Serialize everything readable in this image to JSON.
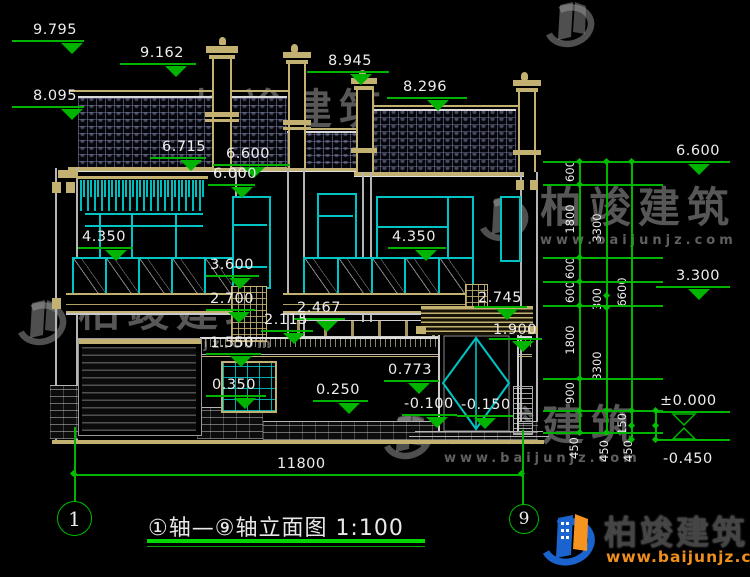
{
  "watermark": {
    "brand": "柏竣建筑",
    "url": "www.baijunjz.com"
  },
  "logo": {
    "brand": "柏竣建筑",
    "url": "www.baijunjz.com"
  },
  "title_block": {
    "title": "①轴—⑨轴立面图 1:100",
    "axis_left": "1",
    "axis_right": "9"
  },
  "drawing": {
    "bottom_dim_label": "11800",
    "elevation_markers": [
      {
        "label": "9.795",
        "tx": 33,
        "ty": 22,
        "lx": 12,
        "ly": 40,
        "lw": 72,
        "ax": 72
      },
      {
        "label": "9.162",
        "tx": 140,
        "ty": 45,
        "lx": 120,
        "ly": 63,
        "lw": 76,
        "ax": 176
      },
      {
        "label": "8.095",
        "tx": 33,
        "ty": 88,
        "lx": 12,
        "ly": 106,
        "lw": 72,
        "ax": 72
      },
      {
        "label": "8.945",
        "tx": 328,
        "ty": 53,
        "lx": 307,
        "ly": 71,
        "lw": 82,
        "ax": 361
      },
      {
        "label": "8.296",
        "tx": 403,
        "ty": 79,
        "lx": 387,
        "ly": 97,
        "lw": 80,
        "ax": 438
      },
      {
        "label": "6.715",
        "tx": 162,
        "ty": 139,
        "lx": 150,
        "ly": 157,
        "lw": 56,
        "ax": 191
      },
      {
        "label": "6.600",
        "tx": 226,
        "ty": 146,
        "lx": 213,
        "ly": 164,
        "lw": 77,
        "ax": 254
      },
      {
        "label": "6.000",
        "tx": 213,
        "ty": 166,
        "lx": 208,
        "ly": 184,
        "lw": 47,
        "ax": 242
      },
      {
        "label": "6.600",
        "tx": 676,
        "ty": 143,
        "lx": 656,
        "ly": 161,
        "lw": 74,
        "ax": 699
      },
      {
        "label": "4.350",
        "tx": 82,
        "ty": 229,
        "lx": 78,
        "ly": 247,
        "lw": 55,
        "ax": 116
      },
      {
        "label": "4.350",
        "tx": 392,
        "ty": 229,
        "lx": 388,
        "ly": 247,
        "lw": 58,
        "ax": 426
      },
      {
        "label": "3.600",
        "tx": 210,
        "ty": 257,
        "lx": 206,
        "ly": 275,
        "lw": 53,
        "ax": 240
      },
      {
        "label": "2.700",
        "tx": 210,
        "ty": 291,
        "lx": 206,
        "ly": 309,
        "lw": 49,
        "ax": 239
      },
      {
        "label": "2.467",
        "tx": 297,
        "ty": 300,
        "lx": 293,
        "ly": 318,
        "lw": 52,
        "ax": 327
      },
      {
        "label": "2.115",
        "tx": 264,
        "ty": 312,
        "lx": 261,
        "ly": 330,
        "lw": 52,
        "ax": 294
      },
      {
        "label": "1.550",
        "tx": 210,
        "ty": 335,
        "lx": 206,
        "ly": 353,
        "lw": 55,
        "ax": 241
      },
      {
        "label": "0.350",
        "tx": 212,
        "ty": 377,
        "lx": 206,
        "ly": 395,
        "lw": 60,
        "ax": 245
      },
      {
        "label": "0.250",
        "tx": 316,
        "ty": 382,
        "lx": 313,
        "ly": 400,
        "lw": 55,
        "ax": 349
      },
      {
        "label": "0.773",
        "tx": 388,
        "ty": 362,
        "lx": 384,
        "ly": 380,
        "lw": 55,
        "ax": 419
      },
      {
        "label": "-0.100",
        "tx": 404,
        "ty": 396,
        "lx": 402,
        "ly": 414,
        "lw": 55,
        "ax": 437
      },
      {
        "label": "-0.150",
        "tx": 461,
        "ty": 397,
        "lx": 457,
        "ly": 415,
        "lw": 56,
        "ax": 485
      },
      {
        "label": "2.745",
        "tx": 478,
        "ty": 290,
        "lx": 474,
        "ly": 306,
        "lw": 53,
        "ax": 507
      },
      {
        "label": "1.900",
        "tx": 493,
        "ty": 322,
        "lx": 489,
        "ly": 338,
        "lw": 53,
        "ax": 523
      },
      {
        "label": "3.300",
        "tx": 676,
        "ty": 268,
        "lx": 656,
        "ly": 286,
        "lw": 74,
        "ax": 699
      },
      {
        "label": "±0.000",
        "tx": 660,
        "ty": 393,
        "lx": 656,
        "ly": 411,
        "lw": 74,
        "ax": 684,
        "open": true
      },
      {
        "label": "-0.450",
        "tx": 663,
        "ty": 451,
        "lx": 656,
        "ly": 439,
        "lw": 74,
        "ax": 684,
        "open": true,
        "flip": true
      }
    ],
    "chain_labels": [
      {
        "label": "600",
        "x": 570,
        "y": 172
      },
      {
        "label": "1800",
        "x": 570,
        "y": 220
      },
      {
        "label": "600",
        "x": 570,
        "y": 269
      },
      {
        "label": "600",
        "x": 570,
        "y": 293
      },
      {
        "label": "1800",
        "x": 570,
        "y": 341
      },
      {
        "label": "900",
        "x": 570,
        "y": 394
      },
      {
        "label": "450",
        "x": 574,
        "y": 449
      },
      {
        "label": "3300",
        "x": 597,
        "y": 229
      },
      {
        "label": "300",
        "x": 597,
        "y": 300
      },
      {
        "label": "3300",
        "x": 597,
        "y": 367
      },
      {
        "label": "450",
        "x": 604,
        "y": 452
      },
      {
        "label": "6600",
        "x": 622,
        "y": 293
      },
      {
        "label": "150",
        "x": 622,
        "y": 425
      },
      {
        "label": "450",
        "x": 628,
        "y": 452
      }
    ],
    "geometry": {
      "ext_lines": [
        [
          543,
          161,
          120
        ],
        [
          543,
          184,
          120
        ],
        [
          543,
          257,
          120
        ],
        [
          543,
          281,
          120
        ],
        [
          543,
          305,
          120
        ],
        [
          543,
          378,
          120
        ],
        [
          543,
          410,
          120
        ],
        [
          543,
          432,
          120
        ]
      ],
      "chain_lines": [
        [
          579,
          161,
          272
        ],
        [
          606,
          161,
          272
        ],
        [
          631,
          161,
          280
        ],
        [
          655,
          410,
          31
        ]
      ],
      "ticks": [
        [
          577,
          159
        ],
        [
          577,
          182
        ],
        [
          577,
          255
        ],
        [
          577,
          279
        ],
        [
          577,
          303
        ],
        [
          577,
          376
        ],
        [
          577,
          408
        ],
        [
          577,
          430
        ],
        [
          604,
          159
        ],
        [
          604,
          293
        ],
        [
          604,
          305
        ],
        [
          604,
          408
        ],
        [
          604,
          430
        ],
        [
          629,
          159
        ],
        [
          629,
          408
        ],
        [
          629,
          423
        ],
        [
          629,
          437
        ],
        [
          653,
          408
        ],
        [
          653,
          423
        ],
        [
          653,
          437
        ],
        [
          71,
          471
        ],
        [
          519,
          471
        ]
      ]
    },
    "watermarks": [
      {
        "x": 126,
        "y": 88
      },
      {
        "x": 474,
        "y": 186
      },
      {
        "x": 12,
        "y": 290
      },
      {
        "x": 378,
        "y": 404
      },
      {
        "x": 540,
        "y": -8,
        "icon_only": true
      }
    ]
  },
  "colors": {
    "dim_green": "#00b400",
    "title_green": "#00d800",
    "cyan": "#00c4c4",
    "tan": "#c2b170",
    "logo_blue": "#1b64cf",
    "logo_orange": "#f5941e"
  }
}
